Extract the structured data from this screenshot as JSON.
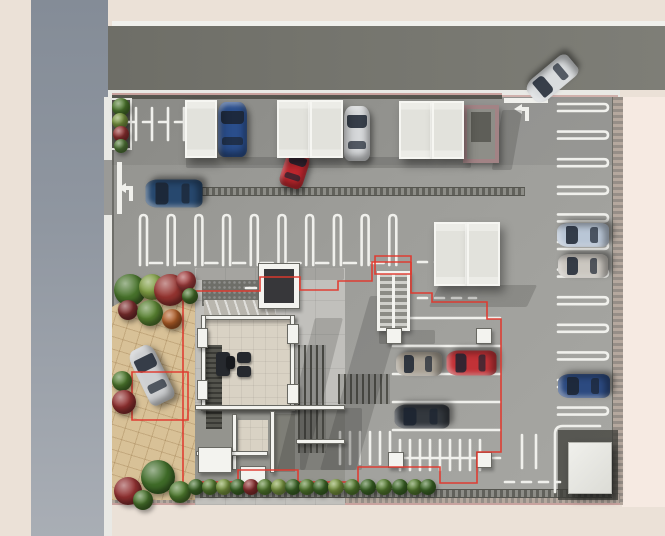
{
  "scene": {
    "description": "Top-down 3D architectural rendering of a residential building ground-floor site plan with surface parking lot, carports, landscaping and surrounding streets",
    "canvas": {
      "w": 665,
      "h": 536
    }
  },
  "palette": {
    "background": "#EBE1D7",
    "right_margin": "#F6EAE2",
    "road_vertical": "#8F96A0",
    "road_horizontal": "#74746D",
    "sidewalk": "#E9E9E5",
    "asphalt": "#9E9E9A",
    "stone_plaza": "#D8C197",
    "building_wall": "#F3F3EF",
    "overhang_outline_red": "#E0382D",
    "curb_mauve": "#C9A29E"
  },
  "rects": [
    {
      "n": "right-margin",
      "c": "flat",
      "b": [
        622,
        97,
        43,
        410
      ],
      "f": "#F6EAE2"
    },
    {
      "n": "road-vertical",
      "c": "road-v",
      "b": [
        31,
        0,
        77,
        536
      ]
    },
    {
      "n": "sidewalk-left",
      "c": "flat",
      "b": [
        104,
        97,
        8,
        439
      ],
      "f": "#E9E9E5"
    },
    {
      "n": "left-exit-opening",
      "c": "flat",
      "b": [
        104,
        160,
        10,
        55
      ],
      "f": "#9A9A97"
    },
    {
      "n": "sidewalk-top-line",
      "c": "flat",
      "b": [
        112,
        21,
        553,
        5
      ],
      "f": "#F0F0EC"
    },
    {
      "n": "road-top",
      "c": "road-h",
      "b": [
        108,
        26,
        557,
        64
      ]
    },
    {
      "n": "sidewalk-top",
      "c": "flat",
      "b": [
        108,
        90,
        512,
        8
      ],
      "f": "#E9E9E5"
    },
    {
      "n": "curb-entrance",
      "c": "flat",
      "b": [
        502,
        95,
        116,
        3
      ],
      "f": "#C9A29E",
      "o": ".8"
    },
    {
      "n": "site-asphalt",
      "c": "asphalt",
      "b": [
        112,
        97,
        508,
        408
      ]
    },
    {
      "n": "site-top-shade",
      "c": "flat",
      "b": [
        112,
        97,
        508,
        68
      ],
      "f": "rgba(30,30,28,0.07)"
    },
    {
      "n": "site-left-edge",
      "c": "flat",
      "b": [
        112,
        97,
        2,
        408
      ],
      "f": "rgba(60,60,56,0.45)"
    },
    {
      "n": "wall-top",
      "c": "wall-mauve",
      "b": [
        112,
        93,
        390,
        6
      ]
    },
    {
      "n": "wall-right",
      "c": "wall-tex-v",
      "b": [
        612,
        97,
        10,
        408
      ]
    },
    {
      "n": "wall-bottom",
      "c": "wall-tex-h",
      "b": [
        112,
        494,
        508,
        11
      ]
    },
    {
      "n": "plaza-stone",
      "c": "plaza",
      "b": [
        112,
        278,
        83,
        222
      ],
      "cp": "polygon(0 13%,48% 3%,100% 0,100% 100%,0 100%)"
    },
    {
      "n": "building-apron",
      "c": "concrete",
      "b": [
        195,
        268,
        150,
        237
      ]
    },
    {
      "n": "terrace-gravel",
      "c": "gravel",
      "b": [
        202,
        280,
        62,
        26
      ]
    },
    {
      "n": "terrace-steps",
      "c": "steps",
      "b": [
        204,
        300,
        72,
        26
      ]
    },
    {
      "n": "lobby-floor",
      "c": "tile",
      "b": [
        205,
        318,
        90,
        92
      ]
    },
    {
      "n": "lower-rooms-floor",
      "c": "flat",
      "b": [
        195,
        408,
        150,
        90
      ],
      "f": "#94948E"
    },
    {
      "n": "lower-room-tile",
      "c": "tile",
      "b": [
        238,
        420,
        30,
        32
      ]
    },
    {
      "n": "lower-room-dark",
      "c": "flat",
      "b": [
        275,
        414,
        20,
        58
      ],
      "f": "#7E7E77"
    },
    {
      "n": "bike-hatch-a",
      "c": "hatch",
      "b": [
        298,
        345,
        28,
        108
      ]
    },
    {
      "n": "bike-hatch-b",
      "c": "hatch",
      "b": [
        338,
        374,
        52,
        30
      ]
    },
    {
      "n": "trellis",
      "c": "hatch-dark",
      "b": [
        206,
        345,
        16,
        84
      ]
    },
    {
      "n": "drain-top",
      "c": "drain",
      "b": [
        170,
        187,
        355,
        7
      ]
    },
    {
      "n": "drain-bottom",
      "c": "drain",
      "b": [
        200,
        489,
        412,
        7
      ]
    },
    {
      "n": "corner-pad",
      "c": "flat",
      "b": [
        558,
        430,
        60,
        70
      ],
      "f": "rgba(62,62,56,0.75)"
    },
    {
      "n": "planter-top-left",
      "c": "planter",
      "b": [
        110,
        98,
        22,
        52
      ]
    }
  ],
  "rects2": [
    {
      "n": "shadow-building-right",
      "c": "shadow",
      "b": [
        296,
        318,
        28,
        152
      ],
      "t": "skewX(-14deg)"
    },
    {
      "n": "shadow-overhang",
      "c": "shadow",
      "b": [
        345,
        296,
        36,
        174
      ],
      "t": "skewX(-16deg)"
    },
    {
      "n": "shadow-carports-top",
      "c": "shadow",
      "b": [
        186,
        157,
        285,
        11
      ]
    },
    {
      "n": "shadow-carports-mid",
      "c": "shadow",
      "b": [
        434,
        285,
        98,
        22
      ],
      "t": "skewX(-25deg)"
    },
    {
      "n": "shadow-enclosure",
      "c": "shadow",
      "b": [
        497,
        110,
        20,
        60
      ],
      "t": "skewX(-10deg)"
    },
    {
      "n": "shadow-stair",
      "c": "shadow",
      "b": [
        379,
        330,
        56,
        14
      ]
    },
    {
      "n": "shadow-terrace-top",
      "c": "shadow",
      "b": [
        196,
        268,
        148,
        12
      ]
    },
    {
      "n": "shadow-lower",
      "c": "shadow",
      "b": [
        300,
        408,
        62,
        62
      ]
    },
    {
      "n": "lobby-wall-top",
      "c": "wallw",
      "b": [
        201,
        315,
        94,
        5
      ]
    },
    {
      "n": "lobby-wall-bottom",
      "c": "wallw",
      "b": [
        201,
        406,
        97,
        5
      ]
    },
    {
      "n": "lobby-wall-left",
      "c": "wallw",
      "b": [
        201,
        315,
        5,
        96
      ]
    },
    {
      "n": "lobby-wall-right",
      "c": "wallw",
      "b": [
        290,
        315,
        5,
        96
      ]
    },
    {
      "n": "lobby-pier-a",
      "c": "wallw",
      "b": [
        197,
        328,
        11,
        20
      ]
    },
    {
      "n": "lobby-pier-b",
      "c": "wallw",
      "b": [
        197,
        380,
        11,
        20
      ]
    },
    {
      "n": "lobby-pier-c",
      "c": "wallw",
      "b": [
        287,
        324,
        12,
        20
      ]
    },
    {
      "n": "lobby-pier-d",
      "c": "wallw",
      "b": [
        287,
        384,
        12,
        20
      ]
    },
    {
      "n": "elevator-core",
      "c": "wallw",
      "b": [
        258,
        263,
        42,
        46
      ]
    },
    {
      "n": "elevator-shaft",
      "c": "flat",
      "b": [
        264,
        269,
        30,
        34
      ],
      "f": "#37373A"
    },
    {
      "n": "stairs",
      "c": "stair",
      "b": [
        377,
        271,
        33,
        60
      ]
    },
    {
      "n": "lower-wall-top",
      "c": "wallw",
      "b": [
        195,
        405,
        150,
        5
      ]
    },
    {
      "n": "lower-wall-a",
      "c": "wallw",
      "b": [
        232,
        414,
        5,
        56
      ]
    },
    {
      "n": "lower-wall-b",
      "c": "wallw",
      "b": [
        196,
        451,
        72,
        5
      ]
    },
    {
      "n": "lower-wall-c",
      "c": "wallw",
      "b": [
        270,
        411,
        5,
        62
      ]
    },
    {
      "n": "lower-wall-d",
      "c": "wallw",
      "b": [
        296,
        439,
        49,
        5
      ]
    },
    {
      "n": "lower-wall-chunk-a",
      "c": "wallw",
      "b": [
        198,
        447,
        34,
        26
      ]
    },
    {
      "n": "lower-wall-chunk-b",
      "c": "wallw",
      "b": [
        240,
        466,
        26,
        22
      ]
    },
    {
      "n": "column-a",
      "c": "wallw",
      "b": [
        386,
        328,
        16,
        16
      ]
    },
    {
      "n": "column-b",
      "c": "wallw",
      "b": [
        476,
        328,
        16,
        16
      ]
    },
    {
      "n": "column-c",
      "c": "wallw",
      "b": [
        388,
        452,
        16,
        16
      ]
    },
    {
      "n": "column-d",
      "c": "wallw",
      "b": [
        476,
        452,
        16,
        16
      ]
    },
    {
      "n": "sofa",
      "c": "furn",
      "b": [
        216,
        352,
        14,
        24
      ]
    },
    {
      "n": "armchair-a",
      "c": "furn",
      "b": [
        237,
        352,
        14,
        11
      ]
    },
    {
      "n": "armchair-b",
      "c": "furn",
      "b": [
        237,
        366,
        14,
        11
      ]
    },
    {
      "n": "coffee-table",
      "c": "furn",
      "b": [
        226,
        356,
        9,
        13
      ],
      "f": "#17191D"
    },
    {
      "n": "utility-cube",
      "c": "cube",
      "b": [
        568,
        442,
        44,
        52
      ]
    },
    {
      "n": "enclosure",
      "c": "enclosure",
      "b": [
        463,
        105,
        36,
        58
      ]
    },
    {
      "n": "enclosure-inner",
      "c": "flat",
      "b": [
        471,
        112,
        20,
        30
      ],
      "f": "#5E5E58"
    }
  ],
  "carports": [
    {
      "n": "carport-roof-1",
      "b": [
        185,
        100,
        32,
        58
      ]
    },
    {
      "n": "carport-roof-2",
      "b": [
        277,
        100,
        33,
        58
      ]
    },
    {
      "n": "carport-roof-3",
      "b": [
        310,
        100,
        33,
        58
      ]
    },
    {
      "n": "carport-roof-4",
      "b": [
        399,
        101,
        33,
        58
      ]
    },
    {
      "n": "carport-roof-5",
      "b": [
        432,
        101,
        32,
        58
      ]
    },
    {
      "n": "carport-roof-6",
      "b": [
        434,
        222,
        33,
        64
      ]
    },
    {
      "n": "carport-roof-7",
      "b": [
        467,
        222,
        33,
        64
      ]
    }
  ],
  "cars": [
    {
      "n": "car-blue-carport",
      "b": [
        218,
        102,
        29,
        55
      ],
      "rot": 0,
      "cv": "#2A4E8C"
    },
    {
      "n": "car-silver-carport",
      "b": [
        344,
        106,
        26,
        55
      ],
      "rot": 0,
      "cv": "#D6D8DA"
    },
    {
      "n": "car-red-compact",
      "b": [
        283,
        150,
        24,
        38
      ],
      "rot": 18,
      "cv": "#C0272E"
    },
    {
      "n": "car-blue-driving",
      "b": [
        160,
        165,
        28,
        57
      ],
      "rot": -90,
      "cv": "#27486E"
    },
    {
      "n": "car-silver-entering",
      "b": [
        539,
        52,
        26,
        54
      ],
      "rot": -130,
      "cv": "#D9DCDE"
    },
    {
      "n": "car-silver-plaza",
      "b": [
        138,
        345,
        27,
        60
      ],
      "rot": -26,
      "cv": "#CDCFD1"
    },
    {
      "n": "car-tan-parked",
      "b": [
        407,
        341,
        24,
        46
      ],
      "rot": -90,
      "cv": "#A8A093"
    },
    {
      "n": "car-red-parked",
      "b": [
        459,
        338,
        25,
        50
      ],
      "rot": -90,
      "cv": "#C23237"
    },
    {
      "n": "car-dark-parked",
      "b": [
        410,
        389,
        24,
        55
      ],
      "rot": -90,
      "cv": "#33383E"
    },
    {
      "n": "car-lightblue-east",
      "b": [
        571,
        209,
        24,
        52
      ],
      "rot": -90,
      "cv": "#B9C6D6"
    },
    {
      "n": "car-beige-east",
      "b": [
        571,
        241,
        24,
        50
      ],
      "rot": -90,
      "cv": "#CBC7C0"
    },
    {
      "n": "car-darkblue-east",
      "b": [
        572,
        360,
        24,
        52
      ],
      "rot": -90,
      "cv": "#2C4A80"
    }
  ],
  "bushes": [
    [
      121,
      107,
      9,
      "#4E7A2E"
    ],
    [
      120,
      121,
      8,
      "#7E9C42"
    ],
    [
      121,
      134,
      8,
      "#963434"
    ],
    [
      121,
      146,
      7,
      "#57803C"
    ],
    [
      130,
      290,
      16,
      "#47722B"
    ],
    [
      152,
      287,
      13,
      "#7E9C42"
    ],
    [
      170,
      290,
      16,
      "#93332F"
    ],
    [
      186,
      281,
      10,
      "#A03C3C"
    ],
    [
      128,
      310,
      10,
      "#7E2F2F"
    ],
    [
      150,
      313,
      13,
      "#578030"
    ],
    [
      172,
      319,
      10,
      "#AF5D27"
    ],
    [
      190,
      296,
      8,
      "#47722B"
    ],
    [
      122,
      381,
      10,
      "#4E7A2E"
    ],
    [
      124,
      402,
      12,
      "#8F3030"
    ],
    [
      158,
      477,
      17,
      "#3F6B28"
    ],
    [
      128,
      491,
      14,
      "#8F3030"
    ],
    [
      180,
      492,
      11,
      "#4E7A2E"
    ],
    [
      143,
      500,
      10,
      "#47722B"
    ],
    [
      196,
      487,
      8,
      "#3F6B28"
    ],
    [
      210,
      487,
      8,
      "#578030"
    ],
    [
      224,
      487,
      8,
      "#7E9C42"
    ],
    [
      238,
      487,
      8,
      "#3F6B28"
    ],
    [
      251,
      487,
      8,
      "#8F3030"
    ],
    [
      265,
      487,
      8,
      "#578030"
    ],
    [
      279,
      487,
      8,
      "#7E9C42"
    ],
    [
      293,
      487,
      8,
      "#3F6B28"
    ],
    [
      307,
      487,
      8,
      "#578030"
    ],
    [
      321,
      487,
      8,
      "#3F6B28"
    ],
    [
      336,
      487,
      8,
      "#7E9C42"
    ],
    [
      352,
      487,
      8,
      "#578030"
    ],
    [
      368,
      487,
      8,
      "#3F6B28"
    ],
    [
      384,
      487,
      8,
      "#578030"
    ],
    [
      400,
      487,
      8,
      "#3F6B28"
    ],
    [
      415,
      487,
      8,
      "#578030"
    ],
    [
      428,
      487,
      8,
      "#3F6B28"
    ]
  ],
  "markings": [
    {
      "k": "stv",
      "n": "parking-staples-row-a",
      "x": 140,
      "y": 215,
      "len": 50,
      "pitch": 27.7,
      "count": 10
    },
    {
      "k": "sth",
      "n": "parking-staples-right-column",
      "x": 558,
      "y": 104,
      "len": 50,
      "pitch": 27.6,
      "count": 12
    },
    {
      "k": "hlines",
      "n": "parking-lines-under-building",
      "x1": 393,
      "x2": 500,
      "ys": [
        318,
        346,
        374,
        402,
        430,
        458
      ]
    },
    {
      "k": "vlines",
      "n": "parking-stripes-bottom-a",
      "x": 340,
      "y": 432,
      "h": 32,
      "pitch": 10,
      "count": 6
    },
    {
      "k": "vlines",
      "n": "parking-stripes-bottom-b",
      "x": 400,
      "y": 440,
      "h": 30,
      "pitch": 10,
      "count": 9
    },
    {
      "k": "vlines",
      "n": "parking-ticks-top-left",
      "x": 136,
      "y": 108,
      "h": 32,
      "pitch": 16,
      "count": 4
    },
    {
      "k": "vlines",
      "n": "lane-ticks-bottom",
      "x": 522,
      "y": 435,
      "h": 33,
      "pitch": 14,
      "count": 2
    },
    {
      "k": "dash",
      "n": "dash-top-left",
      "d": "M127 122 H190",
      "da": "8 8"
    },
    {
      "k": "dash",
      "n": "dash-row-a",
      "d": "M150 263 H385",
      "da": "12 15.7"
    },
    {
      "k": "dash",
      "n": "dash-terrace",
      "d": "M246 288 H302",
      "da": "10 9"
    },
    {
      "k": "dash",
      "n": "dash-mid-a",
      "d": "M418 262 H470",
      "da": "9 8"
    },
    {
      "k": "dash",
      "n": "dash-mid-b",
      "d": "M418 298 H476",
      "da": "9 8"
    },
    {
      "k": "dash",
      "n": "dash-bottom-lane",
      "d": "M505 482 H560",
      "da": "9 8"
    },
    {
      "k": "solid",
      "n": "corner-l-line",
      "d": "M600 426 H563 Q555 426 555 434 V492"
    },
    {
      "k": "fillw",
      "n": "stop-bar-left-exit",
      "d": "M117 162 h5 v52 h-5 z"
    },
    {
      "k": "fillw",
      "n": "stop-bar-entrance",
      "d": "M504 98 h44 v5 h-44 z"
    },
    {
      "k": "fillw",
      "n": "turn-arrow-left-exit",
      "d": "M118 188 L126 183 L126 186 L133 186 L133 201 L129 201 L129 190 L126 190 L126 193 Z"
    },
    {
      "k": "fillw",
      "n": "turn-arrow-entrance",
      "d": "M514 109 L522 104 L522 107 L529 107 L529 121 L525 121 L525 111 L522 111 L522 114 Z"
    }
  ],
  "red_lines": [
    {
      "n": "overhang-outline-plaza-square",
      "d": "M132 372 h56 v48 h-56 z"
    },
    {
      "n": "overhang-outline-left",
      "d": "M183 278 V500"
    },
    {
      "n": "overhang-outline-entry",
      "d": "M183 291 H260 V277 H300 V290 H338 V281 H372 V262 H411"
    },
    {
      "n": "overhang-outline-bike-box",
      "d": "M375 256 h36 v18 h-36 z"
    },
    {
      "n": "overhang-outline-mid",
      "d": "M411 262 V293 H432 V302 H487 V319 H501 V452 H477 V483 H440 V467 H430"
    },
    {
      "n": "overhang-outline-bottom",
      "d": "M430 467 H358 V482 H298 V470 H238 V482 H195"
    }
  ]
}
